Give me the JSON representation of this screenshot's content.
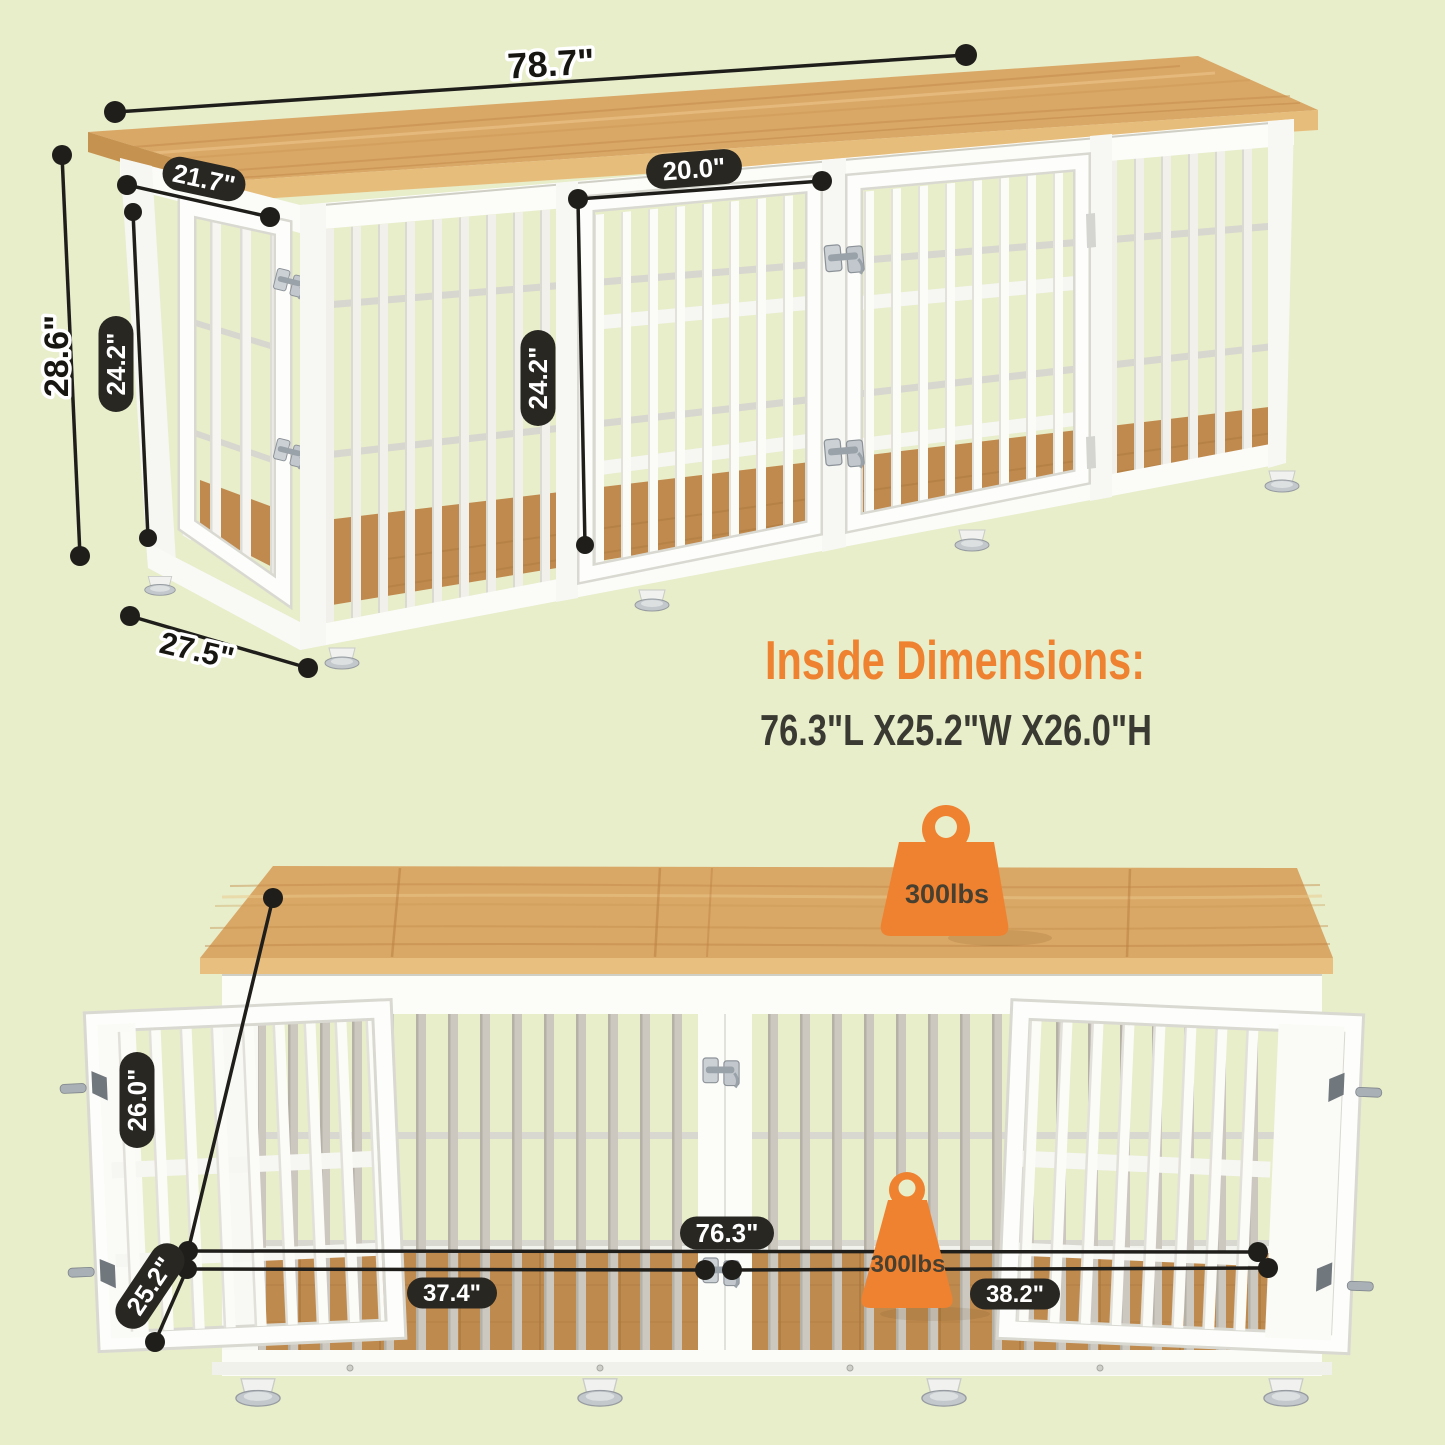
{
  "title": "Dog crate furniture dimension diagram",
  "colors": {
    "background": "#e8edca",
    "accent_orange": "#ee8230",
    "label_pill_black": "#282722",
    "wood_top": "#d9a766",
    "frame_white": "#fcfcf9"
  },
  "icons": {
    "top_weight": "weight-capacity-icon",
    "floor_weight": "weight-capacity-icon"
  },
  "top_view": {
    "length": "78.7\"",
    "top_depth": "21.7\"",
    "door_width": "20.0\"",
    "height": "28.6\"",
    "side_door_height": "24.2\"",
    "front_door_height": "24.2\"",
    "base_depth": "27.5\""
  },
  "inside": {
    "heading": "Inside Dimensions:",
    "value": "76.3\"L X25.2\"W X26.0\"H"
  },
  "bottom_view": {
    "inner_height": "26.0\"",
    "inner_depth": "25.2\"",
    "inner_length": "76.3\"",
    "left_section": "37.4\"",
    "right_section": "38.2\"",
    "top_load": "300lbs",
    "floor_load": "300lbs"
  }
}
